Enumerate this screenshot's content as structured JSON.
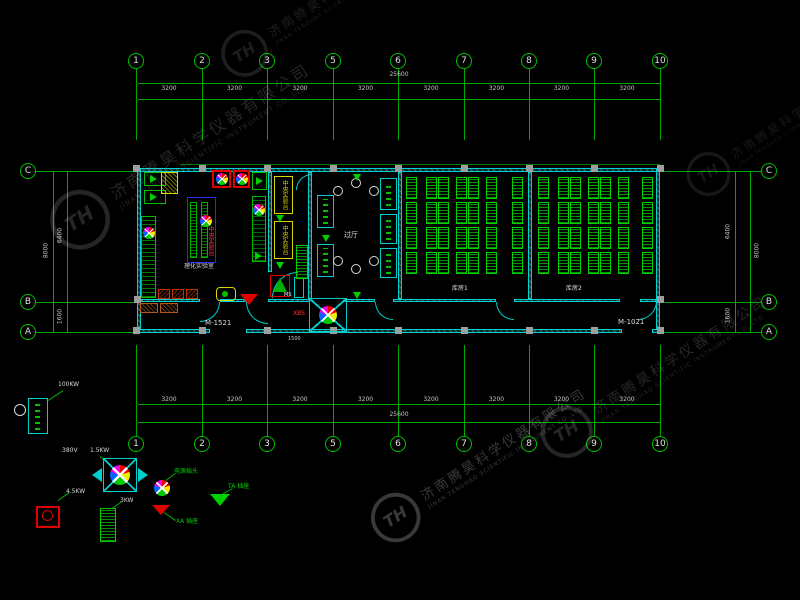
{
  "watermark": {
    "zh": "济南腾昊科学仪器有限公司",
    "en": "JINAN TENGHAO SCIENTIFIC INSTRUMENT CO.,LTD"
  },
  "grid": {
    "column_labels": [
      "1",
      "2",
      "3",
      "5",
      "6",
      "7",
      "8",
      "9",
      "10"
    ],
    "row_labels": [
      "C",
      "B",
      "A"
    ]
  },
  "dims": {
    "segment": "3200",
    "total": "25600",
    "left_overall": "8000",
    "left_upper": "6400",
    "left_lower": "1600",
    "right_overall": "8000",
    "right_upper": "6400",
    "right_lower": "1600",
    "door_width": "1500"
  },
  "plan": {
    "door_left": "M-1521",
    "door_right": "M-1021",
    "room_lab": "理化实验室",
    "room_hall": "过厅",
    "room_store1": "库房1",
    "room_store2": "库房2",
    "tag_ms": "MS",
    "fan_tag": "XBS",
    "bench": "中央实验台"
  },
  "legend": {
    "cabinet_power": "100KW",
    "fan_voltage": "380V",
    "fan_power": "1.5KW",
    "unit_power": "4.5KW",
    "rack_power": "3KW",
    "plug": "电源插头",
    "socket_a": "XA 插座",
    "socket_b": "TA 插座"
  }
}
